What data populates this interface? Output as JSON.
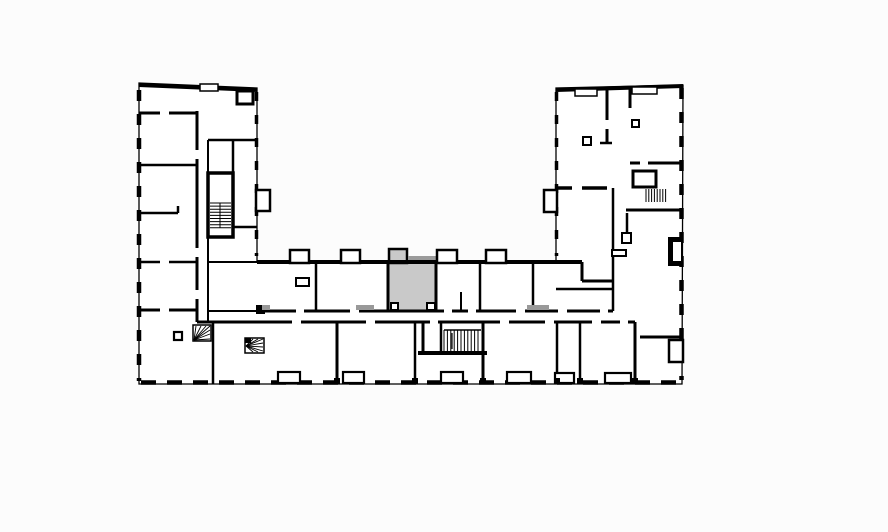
{
  "meta": {
    "canvas": {
      "width": 888,
      "height": 532
    },
    "colors": {
      "background": "#fcfcfc",
      "wall": "#000000",
      "floor": "#ffffff",
      "highlight": "#c9c9c9",
      "slab": "#9b9b9b",
      "threshold": "#999999"
    }
  },
  "floorplan": {
    "outline_points": "139,83 257,88 257,262 556,262 556,88 683,85 682,384 139,384",
    "dashed_edges": [
      {
        "x1": 139,
        "y1": 90,
        "x2": 139,
        "y2": 381,
        "w": 4.5,
        "dash": "11 13"
      },
      {
        "x1": 141,
        "y1": 382.5,
        "x2": 681,
        "y2": 382.5,
        "w": 4.5,
        "dash": "15 11"
      },
      {
        "x1": 681.5,
        "y1": 88,
        "x2": 681.5,
        "y2": 380,
        "w": 4.5,
        "dash": "11 13"
      },
      {
        "x1": 256.5,
        "y1": 92,
        "x2": 256.5,
        "y2": 256,
        "w": 3.5,
        "dash": "9 14"
      },
      {
        "x1": 556.5,
        "y1": 92,
        "x2": 556.5,
        "y2": 256,
        "w": 3.5,
        "dash": "9 14"
      }
    ],
    "fills": [
      {
        "x": 389,
        "y": 262,
        "w": 47,
        "h": 49,
        "fill": "#c9c9c9",
        "name": "highlighted-unit"
      },
      {
        "x": 389,
        "y": 249,
        "w": 18,
        "h": 14,
        "fill": "#c9c9c9",
        "sw": 2.5,
        "name": "highlighted-unit-balcony"
      },
      {
        "x": 408,
        "y": 256,
        "w": 28,
        "h": 4,
        "fill": "#9b9b9b",
        "name": "balcony-slab"
      },
      {
        "x": 668,
        "y": 237,
        "w": 14,
        "h": 29,
        "fill": "#000000",
        "name": "shaft-block"
      }
    ],
    "walls": [
      [
        139,
        85,
        257,
        90,
        4
      ],
      [
        556,
        90,
        683,
        86,
        4
      ],
      [
        257,
        262,
        582,
        262,
        4
      ],
      [
        582,
        262,
        582,
        281,
        3
      ],
      [
        582,
        281,
        614,
        281,
        3
      ],
      [
        139,
        113,
        197,
        113,
        3
      ],
      [
        139,
        165,
        197,
        165,
        2.5
      ],
      [
        139,
        213,
        178,
        213,
        2.5
      ],
      [
        178,
        206,
        178,
        213,
        2.5
      ],
      [
        139,
        262,
        197,
        262,
        2.5
      ],
      [
        208,
        262,
        257,
        262,
        2
      ],
      [
        139,
        310,
        197,
        310,
        3
      ],
      [
        197,
        111,
        197,
        322,
        3
      ],
      [
        208,
        140,
        208,
        173,
        2
      ],
      [
        208,
        237,
        208,
        322,
        2
      ],
      [
        208,
        140,
        257,
        140,
        2.5
      ],
      [
        233,
        227,
        257,
        227,
        2.5
      ],
      [
        233,
        140,
        233,
        173,
        2.5
      ],
      [
        213,
        322,
        213,
        384,
        2.5
      ],
      [
        208,
        311,
        257,
        311,
        2
      ],
      [
        208,
        200,
        233,
        200,
        2.5
      ],
      [
        257,
        311,
        613,
        311,
        3
      ],
      [
        197,
        322,
        635,
        322,
        3
      ],
      [
        316,
        262,
        316,
        311,
        2.5
      ],
      [
        388,
        262,
        388,
        311,
        3
      ],
      [
        436,
        262,
        436,
        311,
        3
      ],
      [
        461,
        292,
        461,
        311,
        2
      ],
      [
        480,
        262,
        480,
        311,
        2.5
      ],
      [
        533,
        262,
        533,
        311,
        2.5
      ],
      [
        613,
        188,
        613,
        311,
        2.5
      ],
      [
        337,
        322,
        337,
        384,
        3
      ],
      [
        415,
        322,
        415,
        384,
        2.5
      ],
      [
        483,
        322,
        483,
        384,
        3
      ],
      [
        557,
        322,
        557,
        384,
        2.5
      ],
      [
        580,
        322,
        580,
        384,
        2.5
      ],
      [
        635,
        322,
        635,
        384,
        3
      ],
      [
        423,
        322,
        423,
        353,
        3
      ],
      [
        441,
        322,
        441,
        353,
        2.5
      ],
      [
        418,
        353,
        487,
        353,
        4
      ],
      [
        607,
        89,
        607,
        143,
        3
      ],
      [
        600,
        143,
        612,
        143,
        2.5
      ],
      [
        630,
        88,
        630,
        108,
        3
      ],
      [
        630,
        163,
        683,
        163,
        3
      ],
      [
        556,
        188,
        607,
        188,
        3.5
      ],
      [
        626,
        210,
        683,
        210,
        3
      ],
      [
        627,
        213,
        627,
        243,
        2.5
      ],
      [
        556,
        289,
        613,
        289,
        2.5
      ],
      [
        640,
        337,
        683,
        337,
        3
      ]
    ],
    "stroked_rects": [
      {
        "x": 208,
        "y": 173,
        "w": 25,
        "h": 64,
        "sw": 3.5,
        "name": "stair-core-left"
      },
      {
        "x": 633,
        "y": 171,
        "w": 23,
        "h": 16,
        "sw": 3,
        "name": "elevator-right"
      },
      {
        "x": 237,
        "y": 91,
        "w": 16,
        "h": 13,
        "sw": 3,
        "name": "shaft-top-left"
      },
      {
        "x": 290,
        "y": 250,
        "w": 19,
        "h": 13,
        "sw": 2.5,
        "name": "balcony"
      },
      {
        "x": 341,
        "y": 250,
        "w": 19,
        "h": 13,
        "sw": 2.5,
        "name": "balcony"
      },
      {
        "x": 437,
        "y": 250,
        "w": 20,
        "h": 13,
        "sw": 2.5,
        "name": "balcony"
      },
      {
        "x": 486,
        "y": 250,
        "w": 20,
        "h": 13,
        "sw": 2.5,
        "name": "balcony"
      },
      {
        "x": 256,
        "y": 190,
        "w": 14,
        "h": 21,
        "sw": 2.5,
        "name": "balcony"
      },
      {
        "x": 544,
        "y": 190,
        "w": 13,
        "h": 22,
        "sw": 2.5,
        "name": "balcony"
      },
      {
        "x": 200,
        "y": 84,
        "w": 18,
        "h": 7,
        "sw": 1.5,
        "name": "window-notch"
      },
      {
        "x": 575,
        "y": 89,
        "w": 22,
        "h": 7,
        "sw": 1.5,
        "name": "window-notch"
      },
      {
        "x": 632,
        "y": 87,
        "w": 25,
        "h": 7,
        "sw": 1.5,
        "name": "window-notch"
      },
      {
        "x": 278,
        "y": 372,
        "w": 22,
        "h": 11,
        "sw": 2.2,
        "name": "balcony"
      },
      {
        "x": 343,
        "y": 372,
        "w": 21,
        "h": 11,
        "sw": 2.2,
        "name": "balcony"
      },
      {
        "x": 441,
        "y": 372,
        "w": 22,
        "h": 11,
        "sw": 2.2,
        "name": "balcony"
      },
      {
        "x": 507,
        "y": 372,
        "w": 24,
        "h": 11,
        "sw": 2.2,
        "name": "balcony"
      },
      {
        "x": 555,
        "y": 373,
        "w": 19,
        "h": 10,
        "sw": 2.2,
        "name": "balcony"
      },
      {
        "x": 605,
        "y": 373,
        "w": 26,
        "h": 10,
        "sw": 2.2,
        "name": "balcony"
      },
      {
        "x": 669,
        "y": 340,
        "w": 14,
        "h": 22,
        "sw": 2.5,
        "name": "balcony"
      },
      {
        "x": 174,
        "y": 332,
        "w": 8,
        "h": 8,
        "sw": 2.2,
        "name": "column"
      },
      {
        "x": 583,
        "y": 137,
        "w": 8,
        "h": 8,
        "sw": 2,
        "name": "column"
      },
      {
        "x": 632,
        "y": 120,
        "w": 7,
        "h": 7,
        "sw": 2,
        "name": "column"
      },
      {
        "x": 622,
        "y": 233,
        "w": 9,
        "h": 10,
        "sw": 2,
        "name": "fixture"
      },
      {
        "x": 612,
        "y": 250,
        "w": 14,
        "h": 6,
        "sw": 2,
        "name": "fixture"
      },
      {
        "x": 296,
        "y": 278,
        "w": 13,
        "h": 8,
        "sw": 2,
        "name": "fixture"
      },
      {
        "x": 391,
        "y": 303,
        "w": 7,
        "h": 7,
        "sw": 2,
        "name": "fixture"
      },
      {
        "x": 427,
        "y": 303,
        "w": 8,
        "h": 7,
        "sw": 2,
        "name": "fixture"
      },
      {
        "x": 672,
        "y": 241,
        "w": 10,
        "h": 21,
        "sw": 2,
        "name": "shaft-inner"
      },
      {
        "x": 193,
        "y": 325,
        "w": 18,
        "h": 16,
        "sw": 1.5,
        "name": "spiral-stair-box"
      },
      {
        "x": 245,
        "y": 338,
        "w": 19,
        "h": 15,
        "sw": 1.5,
        "name": "spiral-stair-box"
      }
    ],
    "black_rects": [
      [
        334,
        378,
        6,
        6
      ],
      [
        412,
        378,
        6,
        6
      ],
      [
        480,
        378,
        6,
        6
      ],
      [
        554,
        378,
        6,
        6
      ],
      [
        577,
        378,
        6,
        6
      ],
      [
        632,
        378,
        6,
        6
      ],
      [
        245,
        338,
        6,
        5
      ],
      [
        256,
        305,
        9,
        9
      ]
    ],
    "tread_sets": [
      {
        "dir": "h",
        "x0": 210,
        "x1": 231,
        "y0": 203,
        "y1": 228,
        "step": 3.1,
        "name": "stairs-left"
      },
      {
        "dir": "v",
        "x0": 646,
        "x1": 668,
        "y0": 189,
        "y1": 202,
        "step": 2.8,
        "name": "stairs-right"
      },
      {
        "dir": "v",
        "x0": 444,
        "x1": 481,
        "y0": 330,
        "y1": 352,
        "step": 3.4,
        "name": "stairs-central"
      }
    ],
    "fans": [
      {
        "cx": 194,
        "cy": 340,
        "ends": [
          [
            196,
            326
          ],
          [
            201,
            326
          ],
          [
            206,
            326
          ],
          [
            210,
            326
          ],
          [
            210,
            330
          ],
          [
            210,
            334
          ],
          [
            210,
            339
          ]
        ],
        "name": "spiral-stair-left"
      },
      {
        "cx": 246,
        "cy": 346,
        "ends": [
          [
            253,
            339
          ],
          [
            258,
            339
          ],
          [
            263,
            339
          ],
          [
            263,
            343
          ],
          [
            263,
            347
          ],
          [
            263,
            351
          ],
          [
            258,
            352
          ],
          [
            253,
            352
          ]
        ],
        "name": "spiral-stair-bottom"
      }
    ],
    "thin_lines": [
      [
        444,
        330,
        481,
        330,
        1.5
      ],
      [
        452,
        349,
        452,
        333,
        1.2
      ],
      [
        220,
        203,
        220,
        228,
        1
      ]
    ],
    "door_gaps": [
      [
        296,
        308,
        8,
        6
      ],
      [
        350,
        308,
        9,
        6
      ],
      [
        444,
        308,
        8,
        6
      ],
      [
        468,
        308,
        8,
        6
      ],
      [
        516,
        308,
        9,
        6
      ],
      [
        558,
        308,
        9,
        6
      ],
      [
        600,
        308,
        8,
        6
      ],
      [
        292,
        319,
        9,
        6
      ],
      [
        366,
        319,
        9,
        6
      ],
      [
        430,
        319,
        8,
        6
      ],
      [
        500,
        319,
        9,
        6
      ],
      [
        545,
        319,
        9,
        6
      ],
      [
        592,
        319,
        9,
        6
      ],
      [
        620,
        319,
        8,
        6
      ],
      [
        194,
        150,
        6,
        9
      ],
      [
        194,
        248,
        6,
        9
      ],
      [
        194,
        290,
        6,
        9
      ],
      [
        572,
        185,
        10,
        6
      ],
      [
        604,
        120,
        6,
        9
      ],
      [
        160,
        110,
        9,
        6
      ],
      [
        160,
        259,
        9,
        6
      ],
      [
        160,
        307,
        9,
        6
      ],
      [
        640,
        160,
        8,
        6
      ]
    ],
    "overlays": [
      {
        "x": 356,
        "y": 305,
        "w": 18,
        "h": 5,
        "fill": "#999999",
        "name": "threshold"
      },
      {
        "x": 527,
        "y": 305,
        "w": 22,
        "h": 5,
        "fill": "#999999",
        "name": "threshold"
      },
      {
        "x": 262,
        "y": 305,
        "w": 8,
        "h": 5,
        "fill": "#999999",
        "name": "threshold"
      }
    ]
  }
}
